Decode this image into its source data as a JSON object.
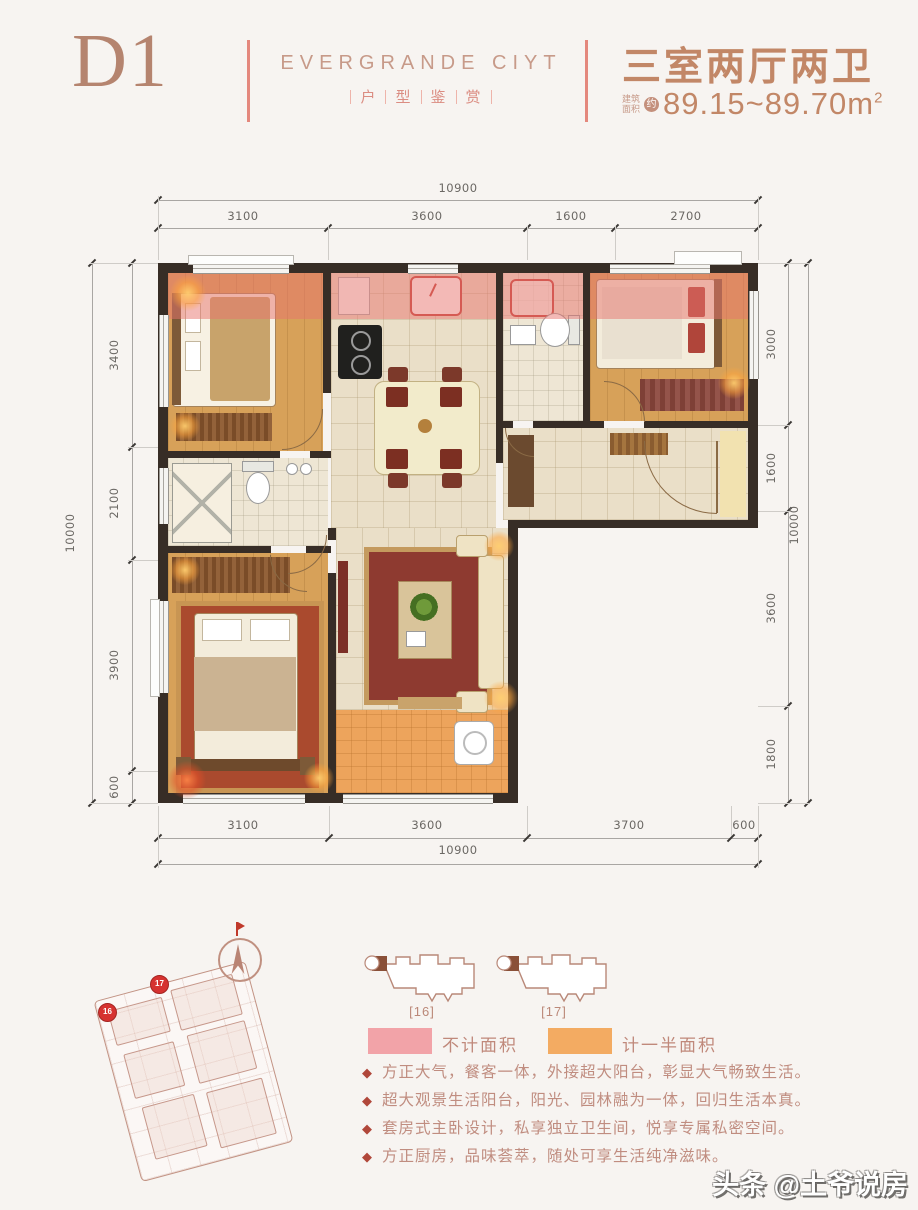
{
  "page": {
    "bg": "#f7f4f1"
  },
  "header": {
    "unit_code": "D1",
    "brand": "EVERGRANDE CIYT",
    "brand_sub_chars": [
      "户",
      "型",
      "鉴",
      "赏"
    ],
    "room_summary": "三室两厅两卫",
    "area_label_line1": "建筑",
    "area_label_line2": "面积",
    "area_approx": "约",
    "area_value": "89.15~89.70m",
    "area_superscript": "2",
    "accent_color": "#c28767"
  },
  "floorplan": {
    "wall_color": "#372d26",
    "colors": {
      "bedroom_floor": "#d7a159",
      "tile_floor": "#eadfc8",
      "bath_floor": "#eee6d4",
      "balcony_floor": "#eda45c",
      "no_area_overlay": "#e87470"
    },
    "dims": {
      "top_overall": "10900",
      "top_segments": [
        "3100",
        "3600",
        "1600",
        "2700"
      ],
      "bottom_segments": [
        "3100",
        "3600",
        "3700",
        "600"
      ],
      "bottom_overall": "10900",
      "left_overall": "10000",
      "left_segments": [
        "3400",
        "2100",
        "3900",
        "600"
      ],
      "right_segments": [
        "3000",
        "1600",
        "3600",
        "1800"
      ],
      "right_overall": "10000"
    }
  },
  "siteplan": {
    "markers": [
      "17",
      "16"
    ]
  },
  "keyplans": [
    {
      "label": "[16]"
    },
    {
      "label": "[17]"
    }
  ],
  "legend": [
    {
      "label": "不计面积",
      "color": "#f2a3a8"
    },
    {
      "label": "计一半面积",
      "color": "#f3ab62"
    }
  ],
  "features": {
    "bullet": "◆",
    "items": [
      "方正大气，餐客一体，外接超大阳台，彰显大气畅致生活。",
      "超大观景生活阳台，阳光、园林融为一体，回归生活本真。",
      "套房式主卧设计，私享独立卫生间，悦享专属私密空间。",
      "方正厨房，品味荟萃，随处可享生活纯净滋味。"
    ]
  },
  "watermark": "头条 @土爷说房"
}
